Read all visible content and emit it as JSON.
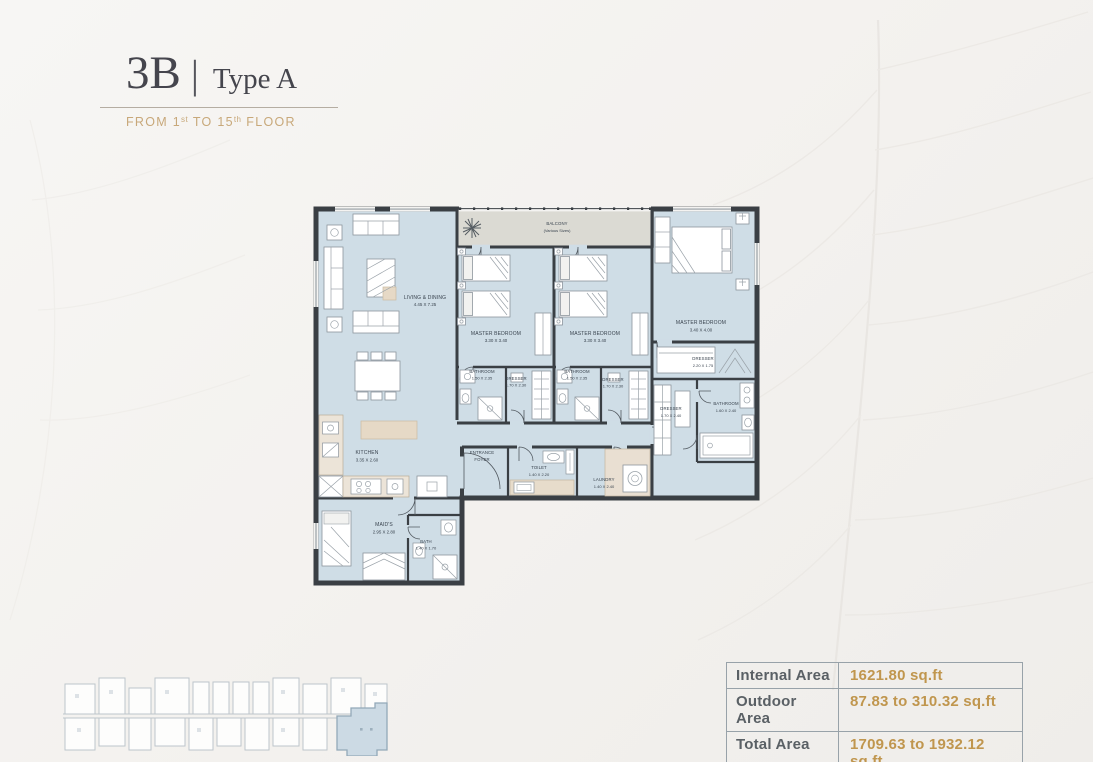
{
  "header": {
    "code": "3B",
    "separator": "|",
    "type_name": "Type A",
    "subtitle": {
      "part1": "FROM 1",
      "sup1": "st",
      "part2": " TO 15",
      "sup2": "th",
      "part3": " FLOOR"
    }
  },
  "floorplan": {
    "balcony": {
      "name": "BALCONY",
      "dim": "(Various Sizes)"
    },
    "rooms": [
      {
        "name": "LIVING & DINING",
        "dim": "4.45 X 7.25"
      },
      {
        "name": "MASTER BEDROOM",
        "dim": "3.30 X 3.40"
      },
      {
        "name": "MASTER BEDROOM",
        "dim": "3.30 X 3.40"
      },
      {
        "name": "MASTER BEDROOM",
        "dim": "3.40 X 4.00"
      },
      {
        "name": "BATHROOM",
        "dim": "1.50 X 2.35"
      },
      {
        "name": "DRESSER",
        "dim": "1.70 X 2.30"
      },
      {
        "name": "BATHROOM",
        "dim": "1.50 X 2.35"
      },
      {
        "name": "DRESSER",
        "dim": "1.70 X 2.30"
      },
      {
        "name": "DRESSER",
        "dim": "2.20 X 1.75"
      },
      {
        "name": "DRESSER",
        "dim": "1.70 X 2.40"
      },
      {
        "name": "BATHROOM",
        "dim": "1.60 X 2.40"
      },
      {
        "name": "KITCHEN",
        "dim": "3.35 X 2.60"
      },
      {
        "name": "ENTRANCE FOYER",
        "line1": "ENTRANCE",
        "line2": "FOYER"
      },
      {
        "name": "TOILET",
        "dim": "1.40 X 2.20"
      },
      {
        "name": "LAUNDRY",
        "dim": "1.40 X 2.40"
      },
      {
        "name": "MAID'S",
        "dim": "2.95 X 2.80"
      },
      {
        "name": "BATH",
        "dim": "1.40 X 1.70"
      }
    ]
  },
  "area_table": {
    "rows": [
      {
        "label": "Internal Area",
        "value": "1621.80 sq.ft"
      },
      {
        "label": "Outdoor Area",
        "value": "87.83 to 310.32 sq.ft"
      },
      {
        "label": "Total Area",
        "value": "1709.63 to 1932.12 sq.ft"
      }
    ]
  },
  "colors": {
    "accent_gold": "#c0964e",
    "subtitle_gold": "#c8a87a",
    "title_dark": "#45454d",
    "wall": "#3a3f44",
    "room_fill": "#cfdde6",
    "balcony_fill": "#dbdad3",
    "furniture_beige": "#e6d9c6",
    "keyplan_highlight": "#ccdae4"
  }
}
